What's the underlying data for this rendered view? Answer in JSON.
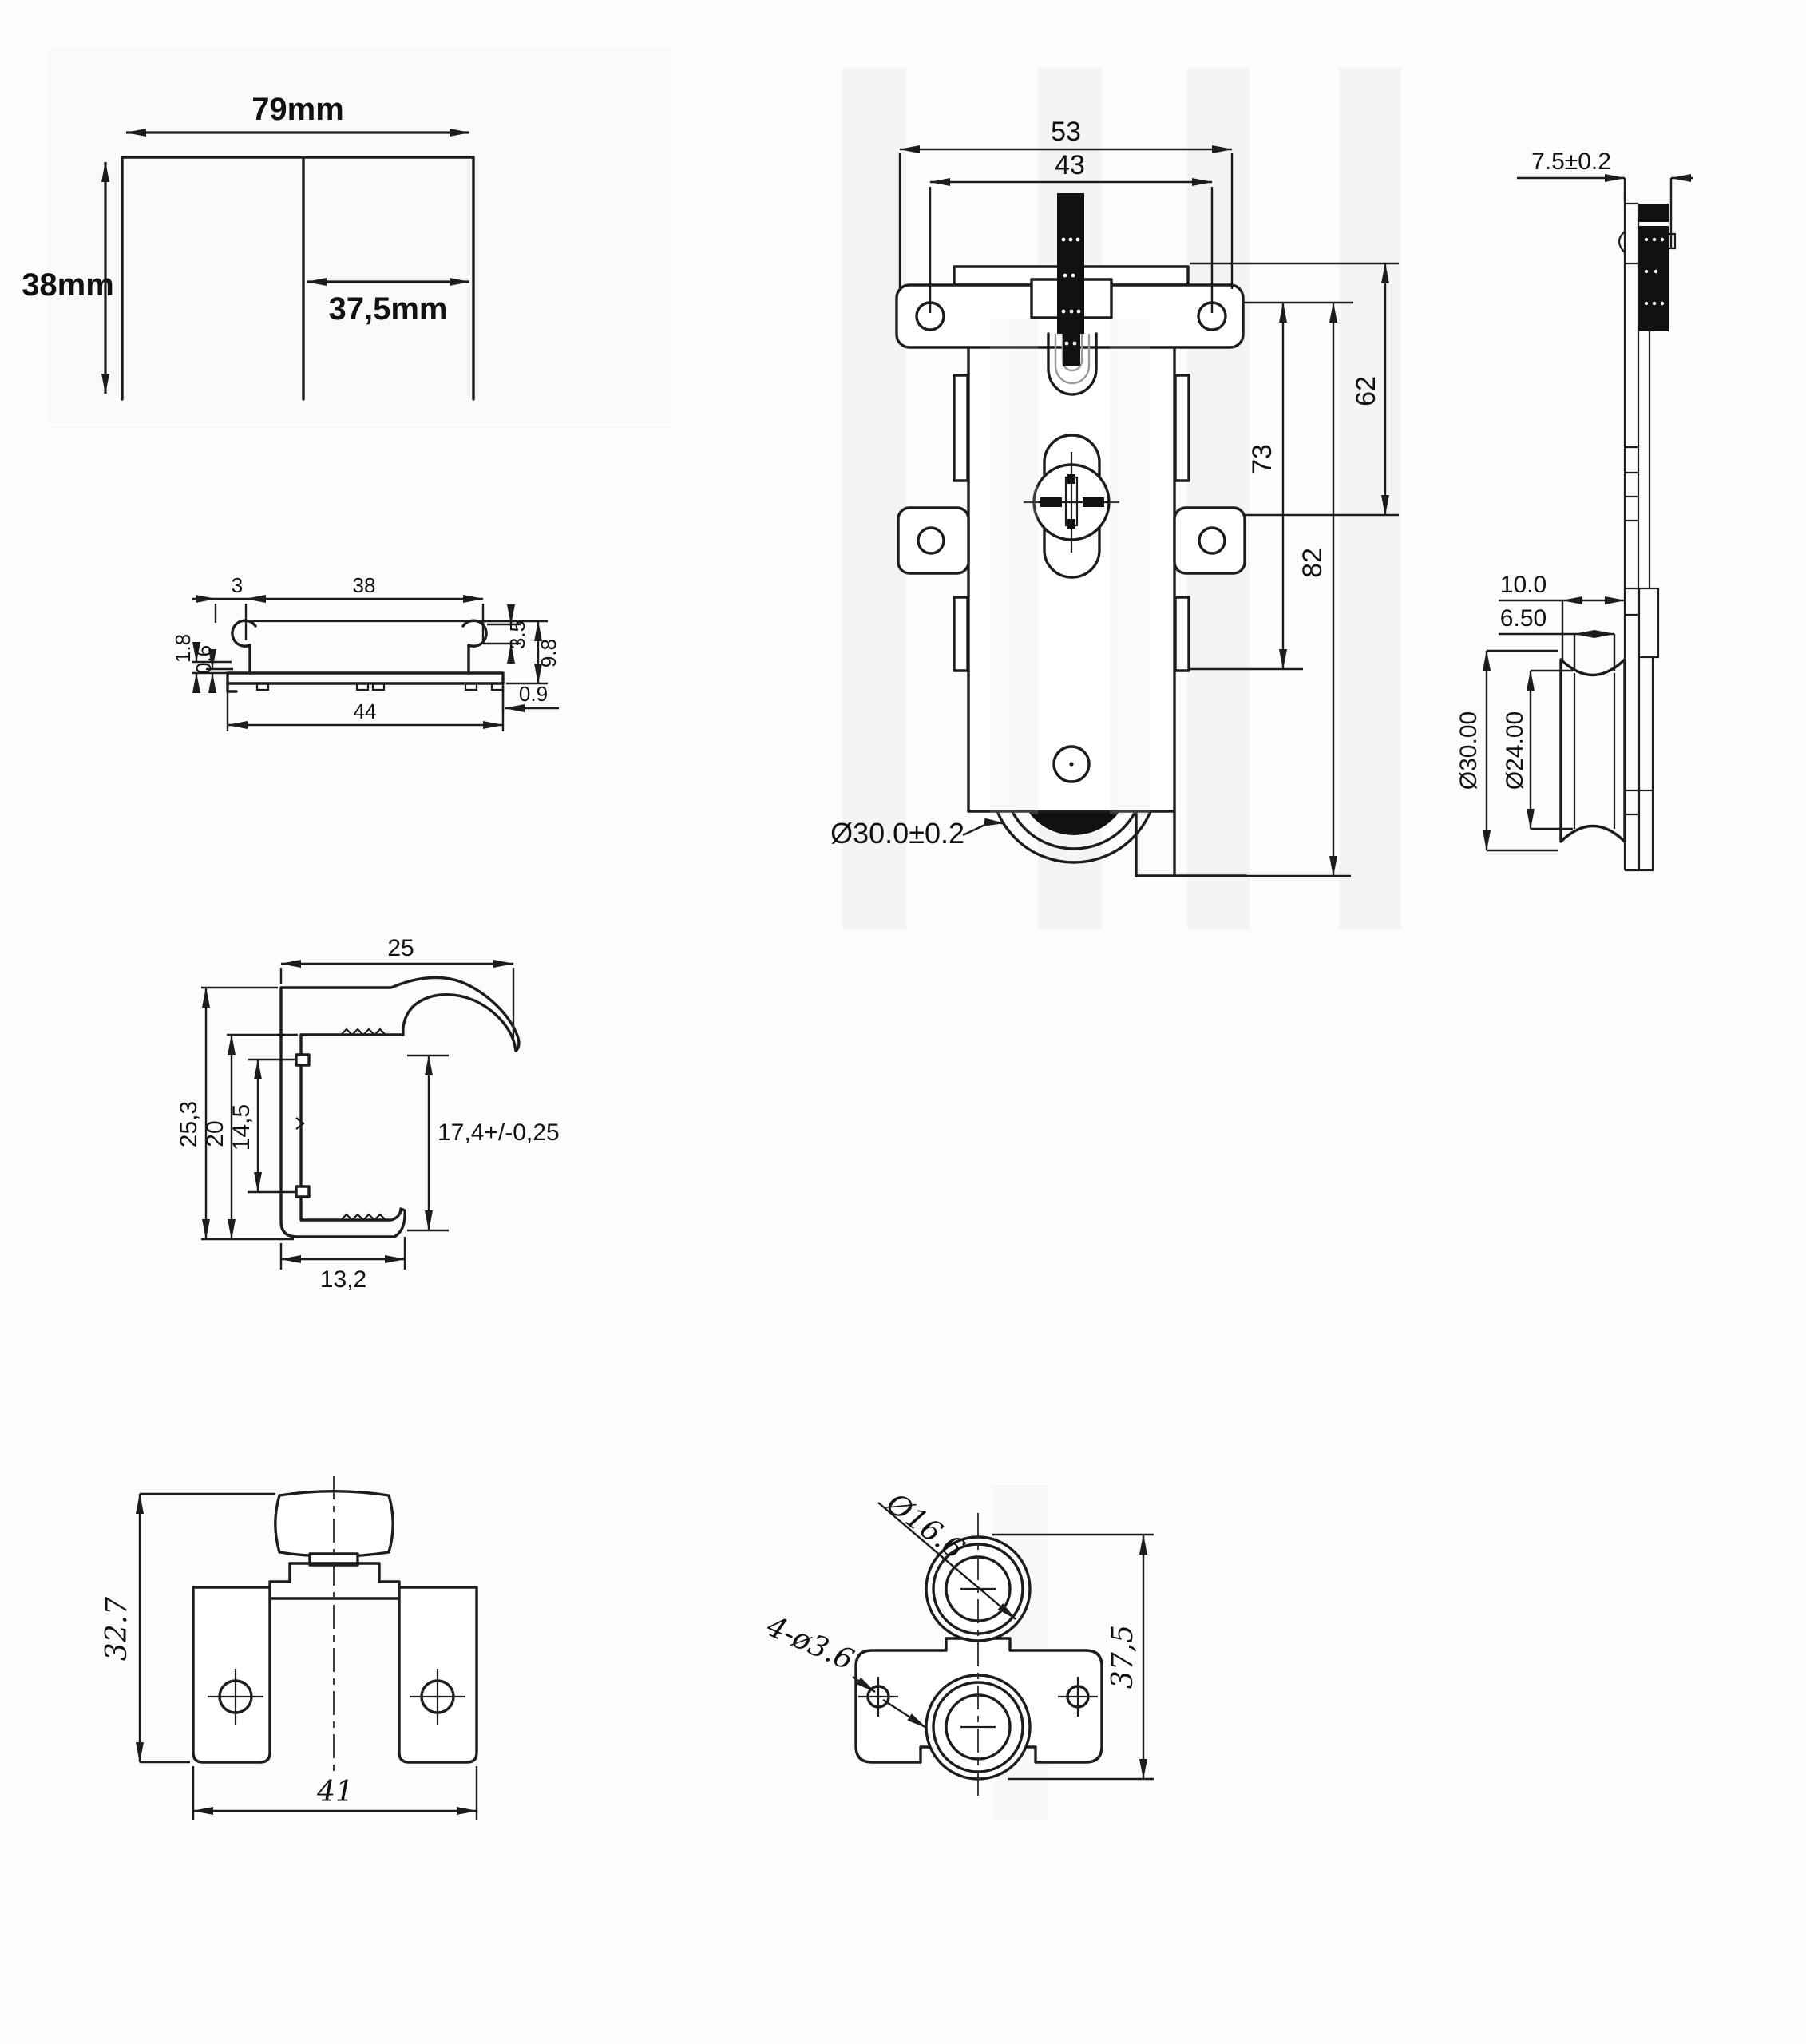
{
  "meta": {
    "sheet_type": "technical drawing set - sliding door roller hardware",
    "colors": {
      "line": "#1c1c1c",
      "background": "#fcfcfc",
      "stripe": "#ececec",
      "screw_fill": "#111111"
    }
  },
  "panel": {
    "width_label": "79mm",
    "height_label": "38mm",
    "half_label": "37,5mm"
  },
  "track": {
    "d3": "3",
    "d38": "38",
    "d35": "3.5",
    "d98": "9.8",
    "d18": "1.8",
    "d06": "0.6",
    "d44": "44",
    "d09": "0.9"
  },
  "roller_front": {
    "d53": "53",
    "d43": "43",
    "d62": "62",
    "d73": "73",
    "d82": "82",
    "wheel_dia": "Ø30.0±0.2"
  },
  "roller_side": {
    "d75": "7.5±0.2",
    "d10": "10.0",
    "d650": "6.50",
    "d30": "Ø30.00",
    "d24": "Ø24.00"
  },
  "handle": {
    "d25": "25",
    "d253": "25,3",
    "d20": "20",
    "d145": "14,5",
    "d174": "17,4+/-0,25",
    "d132": "13,2"
  },
  "bracket": {
    "height": "32.7",
    "width": "41"
  },
  "guide": {
    "roller_dia": "Ø16.6",
    "holes": "4-ø3.6",
    "height": "37,5"
  }
}
